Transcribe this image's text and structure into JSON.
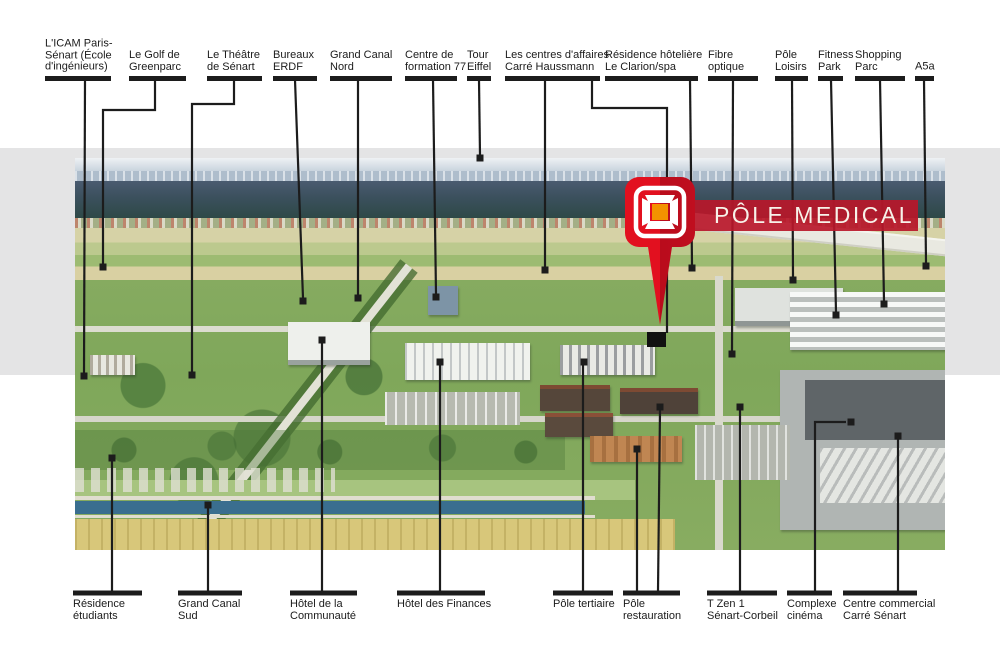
{
  "page": {
    "background": "#ffffff",
    "band_color": "#e4e4e5"
  },
  "banner": {
    "label": "PÔLE MEDICAL",
    "bg": "#b8172a",
    "text_color": "#f7f2e9"
  },
  "pin": {
    "icon": "pole-medical-pin",
    "body_color_left": "#e2101f",
    "body_color_right": "#b90c1c",
    "frame_color": "#ffffff",
    "icon_center_color": "#f39200"
  },
  "callouts": {
    "line_color": "#1c1c1c",
    "top": [
      {
        "id": "icam",
        "lines": [
          "L'ICAM Paris-",
          "Sénart (École",
          "d'ingénieurs)"
        ],
        "bar": [
          45,
          111
        ],
        "paths": [
          "85,80 84,373"
        ],
        "markers": [
          [
            84,
            376
          ]
        ]
      },
      {
        "id": "golf-greenparc",
        "lines": [
          "Le Golf de",
          "Greenparc"
        ],
        "bar": [
          129,
          186
        ],
        "paths": [
          "155,80 155,110 103,110 103,264"
        ],
        "markers": [
          [
            103,
            267
          ]
        ]
      },
      {
        "id": "theatre-senart",
        "lines": [
          "Le Théâtre",
          "de Sénart"
        ],
        "bar": [
          207,
          262
        ],
        "paths": [
          "234,80 234,104 192,104 192,372"
        ],
        "markers": [
          [
            192,
            375
          ]
        ]
      },
      {
        "id": "bureaux-erdf",
        "lines": [
          "Bureaux",
          "ERDF"
        ],
        "bar": [
          273,
          317
        ],
        "paths": [
          "295,80 303,298"
        ],
        "markers": [
          [
            303,
            301
          ]
        ]
      },
      {
        "id": "grand-canal-nord",
        "lines": [
          "Grand Canal",
          "Nord"
        ],
        "bar": [
          330,
          392
        ],
        "paths": [
          "358,80 358,295"
        ],
        "markers": [
          [
            358,
            298
          ]
        ]
      },
      {
        "id": "centre-formation-77",
        "lines": [
          "Centre de",
          "formation 77"
        ],
        "bar": [
          405,
          457
        ],
        "paths": [
          "433,80 436,294"
        ],
        "markers": [
          [
            436,
            297
          ]
        ]
      },
      {
        "id": "tour-eiffel",
        "lines": [
          "Tour",
          "Eiffel"
        ],
        "bar": [
          467,
          491
        ],
        "paths": [
          "479,80 480,155"
        ],
        "markers": [
          [
            480,
            158
          ]
        ]
      },
      {
        "id": "carre-haussmann",
        "lines": [
          "Les centres d'affaires",
          "Carré Haussmann"
        ],
        "bar": [
          505,
          600
        ],
        "paths": [
          "545,80 545,267",
          "592,80 592,108 667,108 667,333"
        ],
        "markers": [
          [
            545,
            270
          ]
        ]
      },
      {
        "id": "clarion-spa",
        "lines": [
          "Résidence hôtelière",
          "Le Clarion/spa"
        ],
        "bar": [
          605,
          698
        ],
        "paths": [
          "690,80 692,265"
        ],
        "markers": [
          [
            692,
            268
          ]
        ]
      },
      {
        "id": "fibre-optique",
        "lines": [
          "Fibre",
          "optique"
        ],
        "bar": [
          708,
          758
        ],
        "paths": [
          "733,80 732,351"
        ],
        "markers": [
          [
            732,
            354
          ]
        ]
      },
      {
        "id": "pole-loisirs",
        "lines": [
          "Pôle",
          "Loisirs"
        ],
        "bar": [
          775,
          808
        ],
        "paths": [
          "792,80 793,277"
        ],
        "markers": [
          [
            793,
            280
          ]
        ]
      },
      {
        "id": "fitness-park",
        "lines": [
          "Fitness",
          "Park"
        ],
        "bar": [
          818,
          843
        ],
        "paths": [
          "831,80 836,312"
        ],
        "markers": [
          [
            836,
            315
          ]
        ]
      },
      {
        "id": "shopping-parc",
        "lines": [
          "Shopping",
          "Parc"
        ],
        "bar": [
          855,
          905
        ],
        "paths": [
          "880,80 884,301"
        ],
        "markers": [
          [
            884,
            304
          ]
        ]
      },
      {
        "id": "a5a",
        "lines": [
          "A5a"
        ],
        "bar": [
          915,
          934
        ],
        "paths": [
          "924,80 926,263"
        ],
        "markers": [
          [
            926,
            266
          ]
        ]
      }
    ],
    "bottom": [
      {
        "id": "residence-etudiants",
        "lines": [
          "Résidence",
          "étudiants"
        ],
        "bar": [
          73,
          142
        ],
        "paths": [
          "112,591 112,461"
        ],
        "markers": [
          [
            112,
            458
          ]
        ]
      },
      {
        "id": "grand-canal-sud",
        "lines": [
          "Grand Canal",
          "Sud"
        ],
        "bar": [
          178,
          242
        ],
        "paths": [
          "208,591 208,508"
        ],
        "markers": [
          [
            208,
            505
          ]
        ]
      },
      {
        "id": "hotel-communaute",
        "lines": [
          "Hôtel de la",
          "Communauté"
        ],
        "bar": [
          290,
          357
        ],
        "paths": [
          "322,591 322,343"
        ],
        "markers": [
          [
            322,
            340
          ]
        ]
      },
      {
        "id": "hotel-finances",
        "lines": [
          "Hôtel des Finances"
        ],
        "bar": [
          397,
          485
        ],
        "paths": [
          "440,591 440,365"
        ],
        "markers": [
          [
            440,
            362
          ]
        ]
      },
      {
        "id": "pole-tertiaire",
        "lines": [
          "Pôle tertiaire"
        ],
        "bar": [
          553,
          613
        ],
        "paths": [
          "583,591 583,365"
        ],
        "markers": [
          [
            584,
            362
          ]
        ]
      },
      {
        "id": "pole-restauration",
        "lines": [
          "Pôle",
          "restauration"
        ],
        "bar": [
          623,
          680
        ],
        "paths": [
          "637,591 637,452",
          "658,591 660,410"
        ],
        "markers": [
          [
            637,
            449
          ],
          [
            660,
            407
          ]
        ]
      },
      {
        "id": "t-zen-1",
        "lines": [
          "T Zen 1",
          "Sénart-Corbeil"
        ],
        "bar": [
          707,
          777
        ],
        "paths": [
          "740,591 740,410"
        ],
        "markers": [
          [
            740,
            407
          ]
        ]
      },
      {
        "id": "complexe-cinema",
        "lines": [
          "Complexe",
          "cinéma"
        ],
        "bar": [
          787,
          832
        ],
        "paths": [
          "815,591 815,422 846,422"
        ],
        "markers": [
          [
            851,
            422
          ]
        ]
      },
      {
        "id": "centre-commercial",
        "lines": [
          "Centre commercial",
          "Carré Sénart"
        ],
        "bar": [
          843,
          917
        ],
        "paths": [
          "898,591 898,439"
        ],
        "markers": [
          [
            898,
            436
          ]
        ]
      }
    ],
    "target_marker": {
      "x": 647,
      "y": 332,
      "w": 19,
      "h": 15
    }
  }
}
